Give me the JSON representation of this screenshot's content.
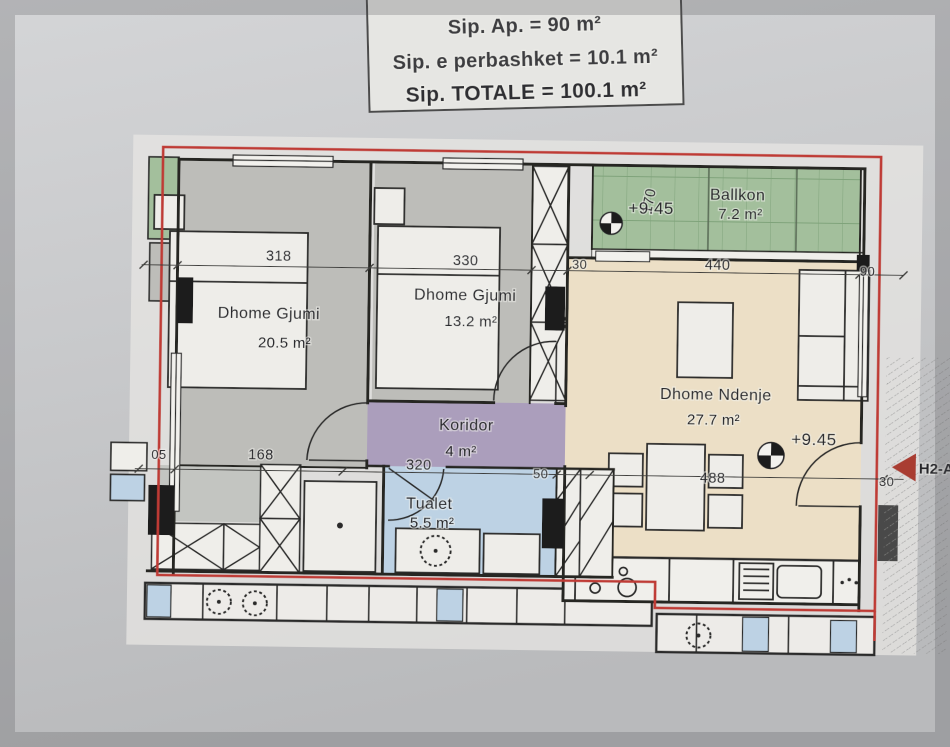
{
  "title_block": {
    "lines": [
      "Sip. Ap. = 90 m²",
      "Sip. e perbashket = 10.1 m²",
      "Sip. TOTALE = 100.1 m²"
    ]
  },
  "rooms": [
    {
      "name": "Dhome Gjumi",
      "area": "20.5 m²"
    },
    {
      "name": "Dhome Gjumi",
      "area": "13.2 m²"
    },
    {
      "name": "Koridor",
      "area": "4 m²"
    },
    {
      "name": "Tualet",
      "area": "5.5 m²"
    },
    {
      "name": "Dhome Ndenje",
      "area": "27.7 m²"
    },
    {
      "name": "Ballkon",
      "area": "7.2 m²"
    }
  ],
  "elevations": [
    {
      "value": "+9.45",
      "location": "balcony"
    },
    {
      "value": "+9.45",
      "location": "living-room"
    }
  ],
  "dimensions": {
    "top_row": [
      "318",
      "330",
      "30",
      "440",
      "90"
    ],
    "bottom_row": [
      "05",
      "168",
      "320",
      "50",
      "488",
      "30"
    ],
    "balcony_depth": "170"
  },
  "unit_label": "H2-A",
  "colors": {
    "boundary_red": "#bf3b34",
    "bedroom_floor": "#bdbdb9",
    "corridor_floor": "#ab9ebc",
    "toilet_floor": "#bdd2e4",
    "living_floor": "#ecdfc6",
    "balcony_floor": "#a3bf9c"
  }
}
